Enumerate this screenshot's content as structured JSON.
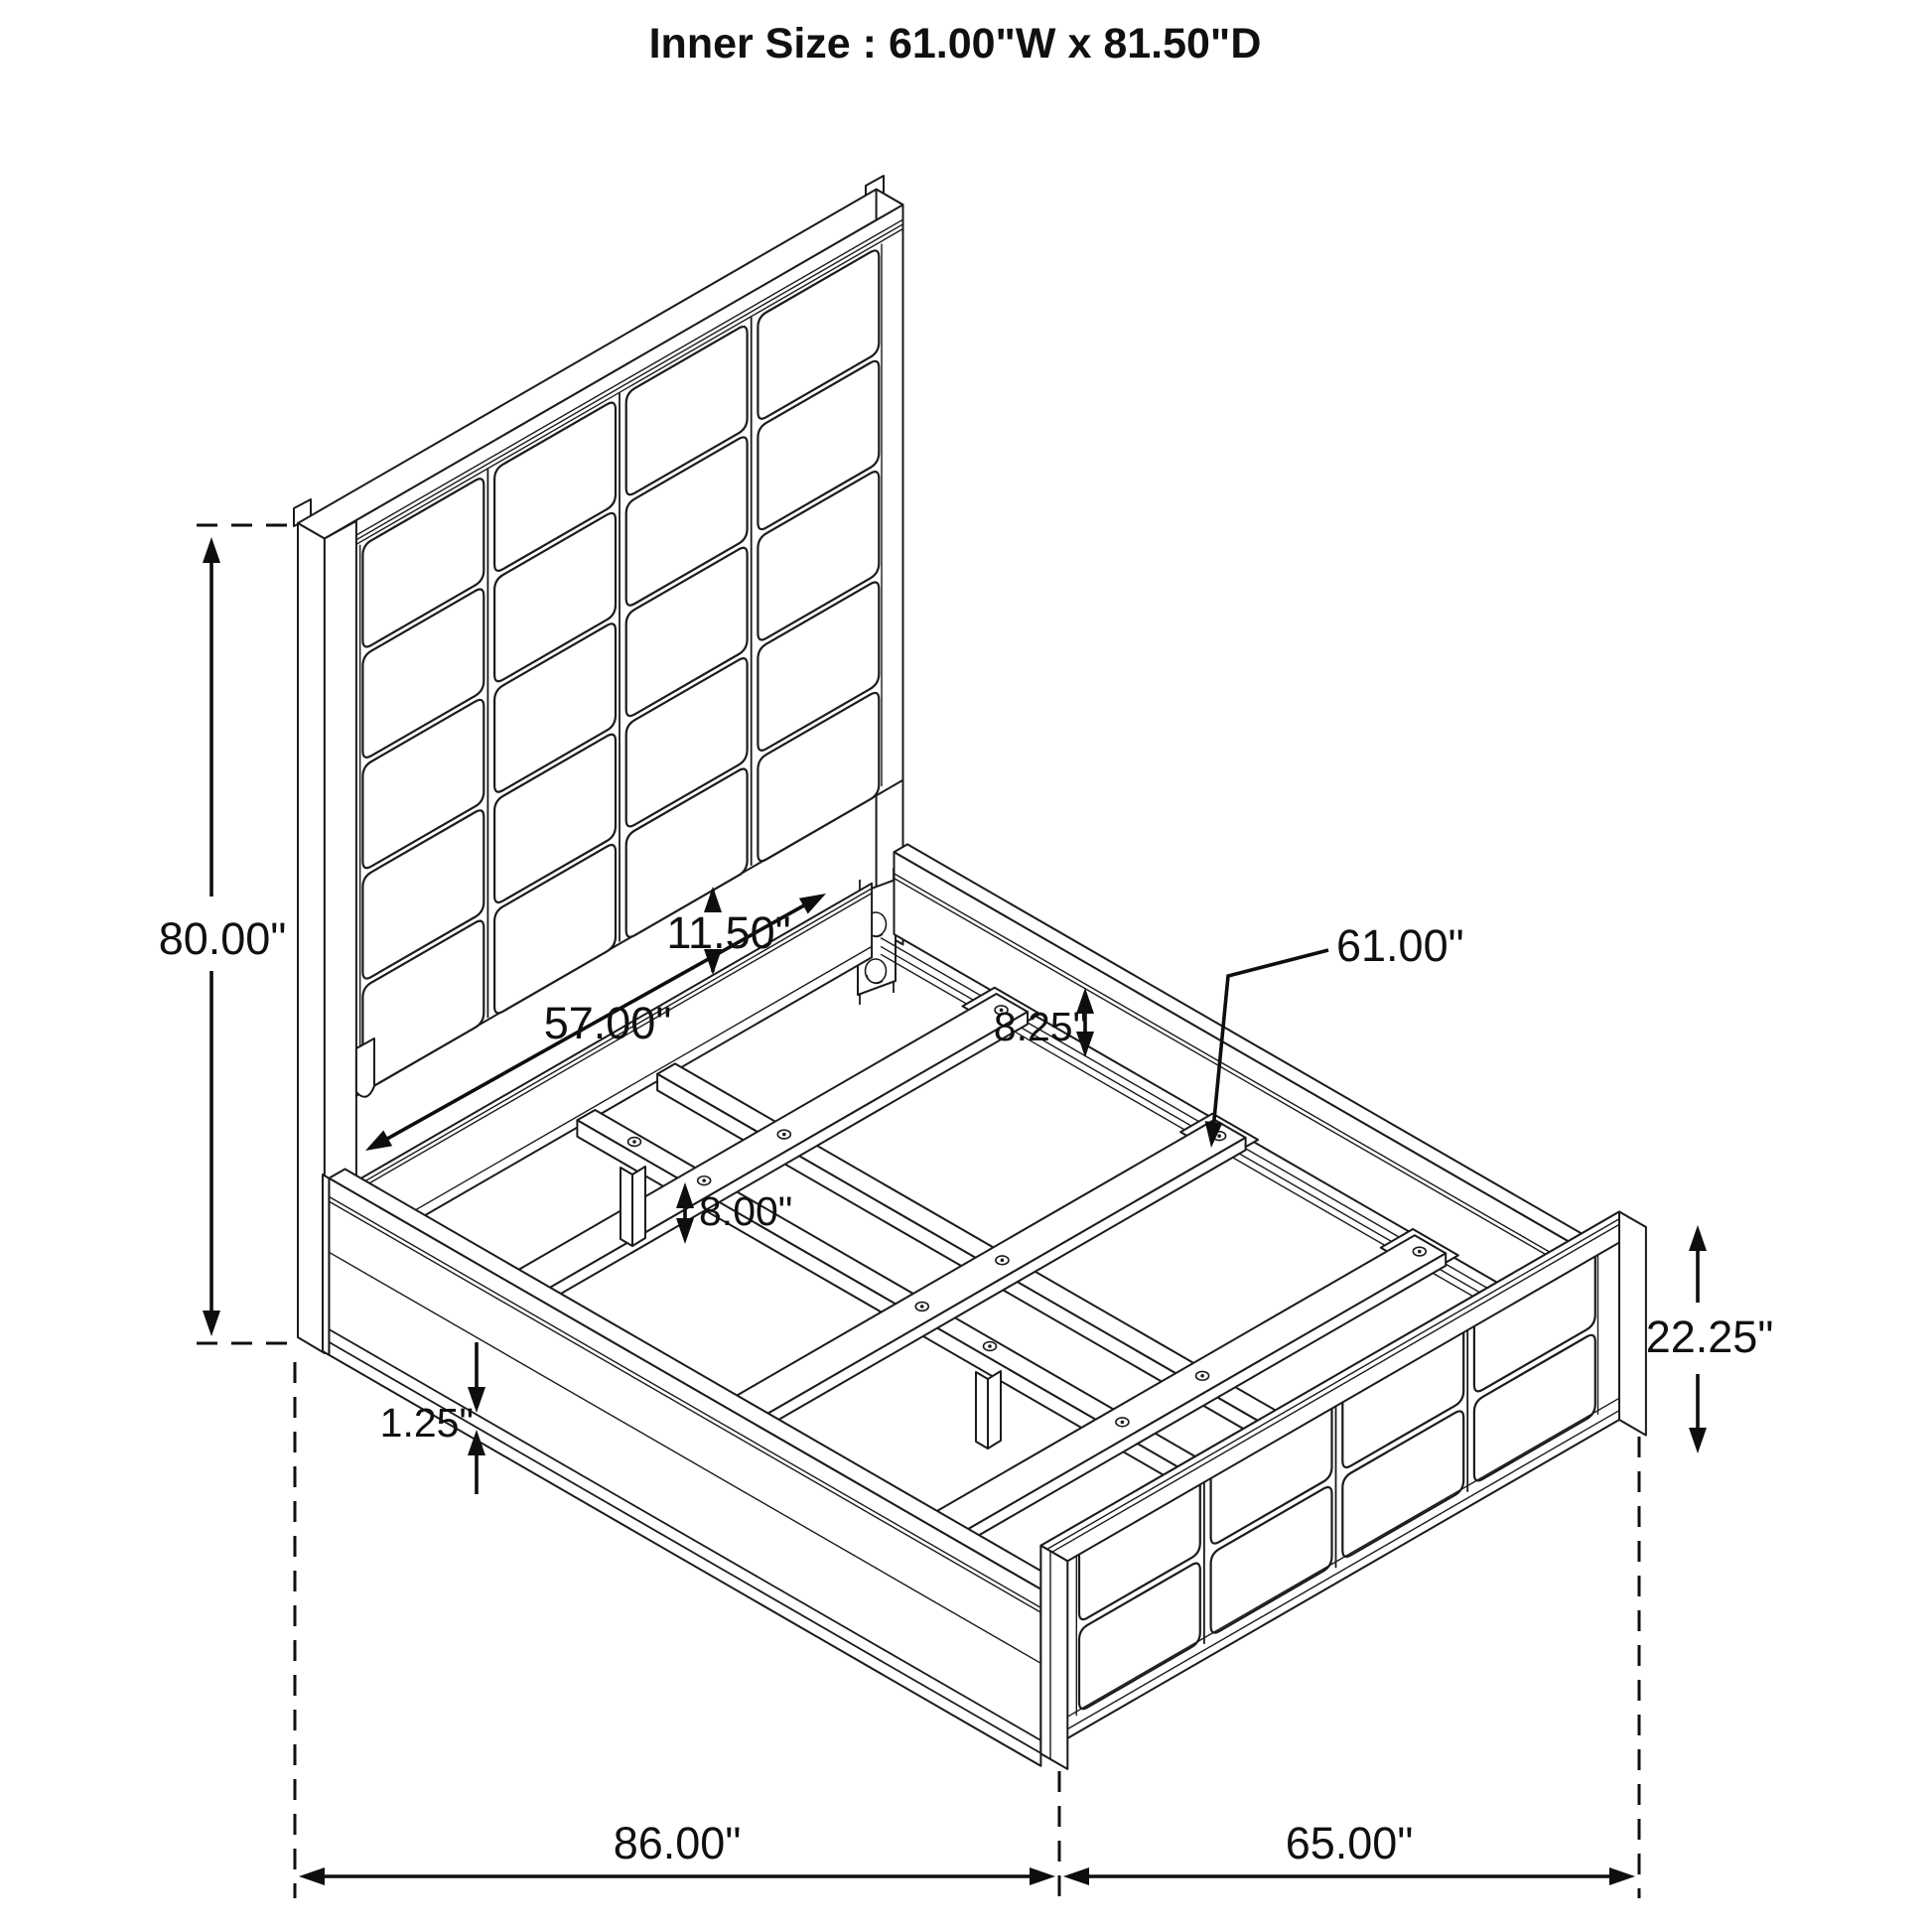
{
  "title": "Inner Size : 61.00\"W x 81.50\"D",
  "dimensions": {
    "headboard_height": "80.00\"",
    "inner_leg_to_leg_width": "57.00\"",
    "panel_to_rail_gap": "11.50\"",
    "rail_to_slat_drop": "8.25\"",
    "slat_length": "61.00\"",
    "center_leg_height": "8.00\"",
    "side_rail_trim": "1.25\"",
    "footboard_height": "22.25\"",
    "overall_length": "86.00\"",
    "overall_width": "65.00\""
  }
}
